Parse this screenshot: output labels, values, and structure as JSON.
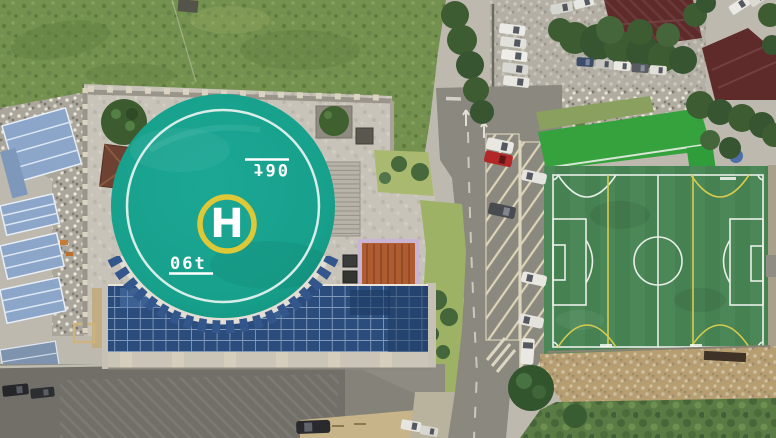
{
  "scene": {
    "name": "aerial-campus-view"
  },
  "helipad": {
    "letter": "H",
    "weight_marking": "06t"
  },
  "palette": {
    "helipad_teal": "#17a18c",
    "ring_yellow": "#ddc838",
    "field_green": "#4c8757",
    "field_line_white": "#e9efe8",
    "field_line_yellow": "#d7cb4e",
    "glass_roof_blue": "#2b4d7d",
    "metal_roof_blue": "#8ba6c8",
    "tile_roof_red": "#5e2a2a",
    "orange_roof": "#b05c31",
    "grass_green": "#74914f",
    "asphalt_gray": "#8b8880",
    "concrete_gray": "#c7c3b8",
    "dirt_tan": "#b79e70"
  }
}
